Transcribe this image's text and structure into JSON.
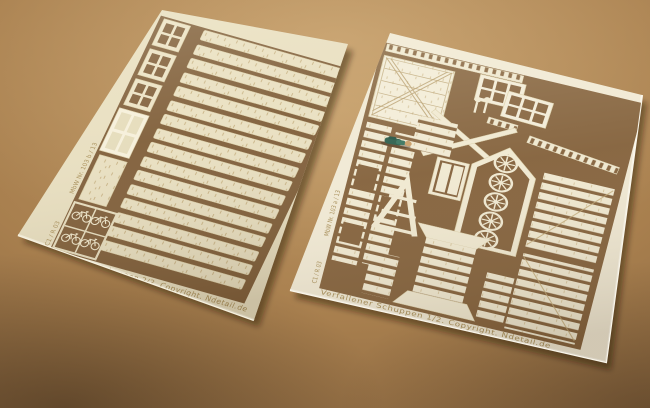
{
  "scene": {
    "type": "photograph",
    "subject": "Two cream laser-cut model-kit sheets (frets) for a derelict shed kit, lying at an angle on a brown cardboard surface, photographed with warm light and dark vignetted corners",
    "surface": "plain warm brown cardboard"
  },
  "colors": {
    "surface_light": "#bd9663",
    "surface_dark": "#553e27",
    "sheet_cream_left": "#e8dfc1",
    "sheet_cream_right": "#f0e9d5",
    "cutout_background": "#7f5e3a",
    "etched_text": "#a78e58",
    "figure_green": "#265a49",
    "figure_skin": "#c79c66"
  },
  "sheets": [
    {
      "position": "left",
      "kit_name": "Verfallener Schuppen",
      "sheet_number": "2/2",
      "edge_label": "Verfallener Schuppen 2/2. Copyright. Ndetail.de",
      "edge_code_1": "C1 / R 03",
      "edge_code_2": "MbW Nr. 103 b / 13",
      "parts": [
        "16 weathered wall plank strips with wood-grain etching",
        "3 small four-pane window frames",
        "1 large four-pane window with light backing",
        "1 blank door panel",
        "4 bicycles in a framed box with dividers"
      ]
    },
    {
      "position": "right",
      "kit_name": "Verfallener Schuppen",
      "sheet_number": "1/2",
      "edge_label": "Verfallener Schuppen 1/2. Copyright. Ndetail.de",
      "edge_code_1": "C1 / R 03",
      "edge_code_2": "MbW Nr. 103 a / 13",
      "parts": [
        "cross-braced barn door",
        "2 six-pane window frames",
        "3 ladders",
        "2 lamp posts",
        "large X roof brace",
        "gable end wall frame",
        "5 spoked wagon wheels nested in the gable",
        "small shuttered window",
        "A-frame trestle",
        "flared slatted plinth tower",
        "plank wall strips with door and window openings",
        "2 large slatted wall panels",
        "short slatted filler strips"
      ]
    }
  ],
  "extras": {
    "figure": "tiny painted miniature person in green work clothes lying on the right sheet for scale"
  }
}
